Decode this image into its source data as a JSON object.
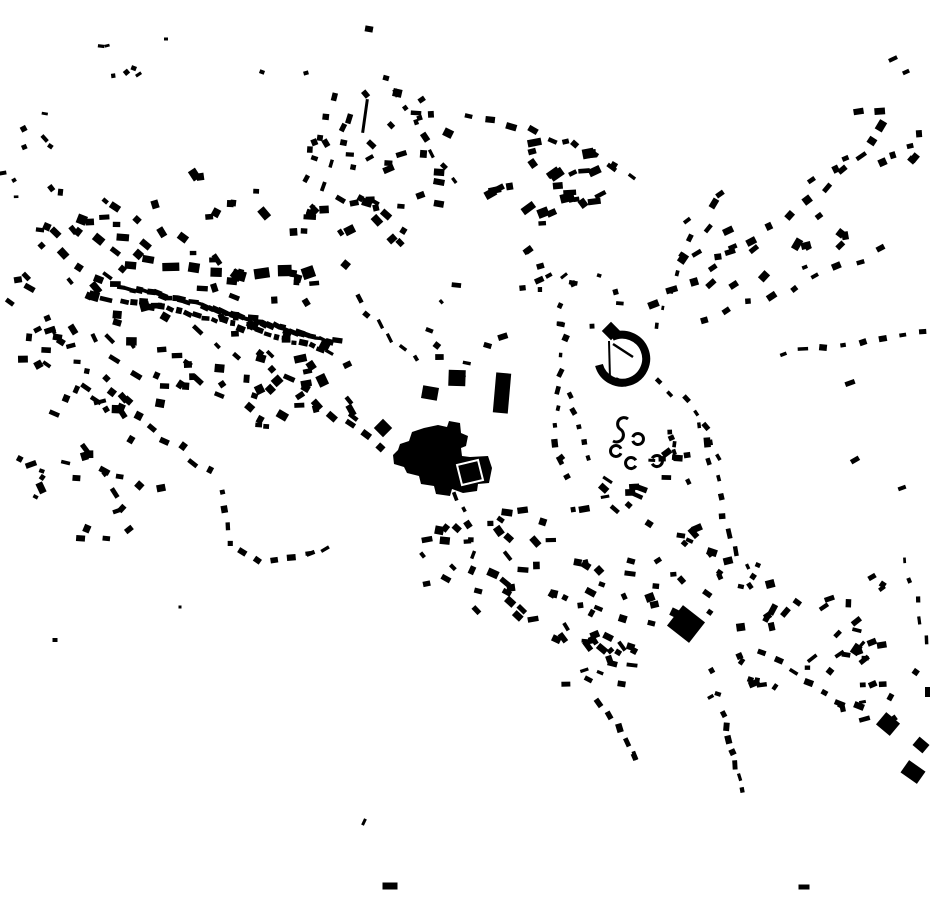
{
  "map": {
    "width": 930,
    "height": 924,
    "background_color": "#ffffff",
    "ink_color": "#000000",
    "seed": 7
  },
  "features": {
    "paths": [
      {
        "name": "central-complex-footprint",
        "d": "M393,455 L398,450 L400,444 L409,441 L412,432 L424,428 L438,425 L447,427 L449,421 L460,423 L461,433 L468,436 L466,446 L461,448 L462,456 L470,457 L488,456 L492,468 L489,483 L478,484 L477,491 L463,493 L452,489 L450,496 L436,494 L434,486 L421,484 L419,476 L407,473 L404,467 L394,464 Z",
        "fill": "#000000"
      },
      {
        "name": "crescent-building-arc",
        "d": "M612,337 A24,24 0 1 1 599,365",
        "stroke": "#000000",
        "sw": 8
      },
      {
        "name": "crescent-chord-wall",
        "d": "M609,341 L610,379",
        "stroke": "#000000",
        "sw": 2
      },
      {
        "name": "crescent-inner-wall",
        "d": "M613,344 L633,357",
        "stroke": "#000000",
        "sw": 2.5
      },
      {
        "name": "s-shaped-ruin",
        "d": "M628,419 A6,6 0 1 0 620,429 A6,6 0 1 1 613,441",
        "stroke": "#000000",
        "sw": 3
      }
    ],
    "overlays": [
      {
        "name": "courtyard-outline",
        "d": "M457,465 L478,460 L483,480 L462,485 Z",
        "stroke": "#ffffff",
        "sw": 2
      }
    ],
    "arcs": [
      {
        "cx": 638,
        "cy": 439,
        "r": 5.5,
        "a0": -160,
        "a1": 160,
        "sw": 3
      },
      {
        "cx": 616,
        "cy": 451,
        "r": 5.5,
        "a0": 25,
        "a1": 335,
        "sw": 3
      },
      {
        "cx": 631,
        "cy": 463,
        "r": 5.5,
        "a0": 30,
        "a1": 330,
        "sw": 3
      },
      {
        "cx": 657,
        "cy": 461,
        "r": 5.5,
        "a0": -150,
        "a1": 150,
        "sw": 3
      }
    ],
    "rects": [
      [
        611,
        331,
        13,
        13,
        45
      ],
      [
        621,
        382,
        12,
        5,
        25
      ],
      [
        457,
        378,
        17,
        16,
        2
      ],
      [
        430,
        393,
        16,
        13,
        10
      ],
      [
        383,
        428,
        13,
        13,
        45
      ],
      [
        502,
        393,
        15,
        40,
        5
      ],
      [
        365,
        116,
        3,
        34,
        8
      ],
      [
        369,
        29,
        8,
        6,
        10
      ],
      [
        262,
        72,
        5,
        4,
        20
      ],
      [
        306,
        73,
        5,
        4,
        -15
      ],
      [
        386,
        78,
        6,
        5,
        15
      ],
      [
        166,
        39,
        4,
        3,
        0
      ],
      [
        893,
        59,
        9,
        4,
        -25
      ],
      [
        906,
        72,
        7,
        4,
        -25
      ],
      [
        850,
        383,
        10,
        5,
        -20
      ],
      [
        855,
        460,
        9,
        5,
        -30
      ],
      [
        902,
        488,
        8,
        4,
        -20
      ],
      [
        872,
        577,
        8,
        5,
        -30
      ],
      [
        888,
        724,
        18,
        16,
        40
      ],
      [
        921,
        745,
        13,
        11,
        40
      ],
      [
        913,
        772,
        20,
        15,
        35
      ],
      [
        928,
        692,
        6,
        10,
        0
      ],
      [
        686,
        624,
        28,
        26,
        38
      ],
      [
        390,
        886,
        15,
        7,
        0
      ],
      [
        804,
        887,
        11,
        5,
        0
      ],
      [
        364,
        822,
        3,
        7,
        25
      ],
      [
        55,
        640,
        5,
        4,
        0
      ],
      [
        180,
        607,
        3,
        3,
        0
      ]
    ]
  },
  "streets": [
    {
      "pts": [
        [
          115,
          286
        ],
        [
          170,
          297
        ],
        [
          230,
          313
        ],
        [
          300,
          334
        ],
        [
          335,
          345
        ]
      ],
      "n": 38,
      "w": 8,
      "h": 5,
      "jit": 2,
      "rj": 12
    },
    {
      "pts": [
        [
          125,
          300
        ],
        [
          200,
          316
        ],
        [
          280,
          336
        ],
        [
          330,
          350
        ]
      ],
      "n": 24,
      "w": 7,
      "h": 5,
      "jit": 3,
      "rj": 15
    },
    {
      "pts": [
        [
          148,
          262
        ],
        [
          205,
          266
        ],
        [
          258,
          277
        ],
        [
          308,
          270
        ]
      ],
      "n": 8,
      "w": 16,
      "h": 10,
      "jit": 4,
      "rj": 12
    },
    {
      "pts": [
        [
          352,
          120
        ],
        [
          330,
          170
        ],
        [
          312,
          215
        ],
        [
          300,
          255
        ]
      ],
      "n": 7,
      "w": 8,
      "h": 5,
      "jit": 4,
      "rj": 15
    },
    {
      "pts": [
        [
          258,
          356
        ],
        [
          300,
          388
        ],
        [
          345,
          422
        ],
        [
          380,
          448
        ]
      ],
      "n": 9,
      "w": 9,
      "h": 6,
      "jit": 5,
      "rj": 15
    },
    {
      "pts": [
        [
          112,
          392
        ],
        [
          160,
          432
        ],
        [
          210,
          470
        ]
      ],
      "n": 8,
      "w": 8,
      "h": 6,
      "jit": 5,
      "rj": 15
    },
    {
      "pts": [
        [
          224,
          492
        ],
        [
          228,
          545
        ],
        [
          262,
          562
        ],
        [
          310,
          552
        ],
        [
          340,
          540
        ]
      ],
      "n": 11,
      "w": 7,
      "h": 5,
      "jit": 3,
      "rj": 15
    },
    {
      "pts": [
        [
          332,
          96
        ],
        [
          312,
          150
        ],
        [
          302,
          200
        ]
      ],
      "n": 6,
      "w": 7,
      "h": 5,
      "jit": 4,
      "rj": 18
    },
    {
      "pts": [
        [
          398,
          92
        ],
        [
          424,
          142
        ],
        [
          452,
          182
        ]
      ],
      "n": 7,
      "w": 7,
      "h": 5,
      "jit": 4,
      "rj": 18
    },
    {
      "pts": [
        [
          468,
          120
        ],
        [
          522,
          128
        ],
        [
          568,
          142
        ],
        [
          612,
          168
        ],
        [
          648,
          192
        ]
      ],
      "n": 10,
      "w": 8,
      "h": 5,
      "jit": 4,
      "rj": 18
    },
    {
      "pts": [
        [
          652,
          302
        ],
        [
          700,
          272
        ],
        [
          748,
          240
        ],
        [
          794,
          206
        ],
        [
          838,
          172
        ],
        [
          878,
          140
        ]
      ],
      "n": 13,
      "w": 9,
      "h": 6,
      "jit": 6,
      "rj": 18
    },
    {
      "pts": [
        [
          705,
          322
        ],
        [
          762,
          300
        ],
        [
          822,
          276
        ],
        [
          882,
          252
        ]
      ],
      "n": 9,
      "w": 8,
      "h": 5,
      "jit": 5,
      "rj": 18
    },
    {
      "pts": [
        [
          783,
          352
        ],
        [
          822,
          346
        ],
        [
          858,
          341
        ],
        [
          894,
          336
        ],
        [
          922,
          329
        ]
      ],
      "n": 8,
      "w": 8,
      "h": 5,
      "jit": 3,
      "rj": 15
    },
    {
      "pts": [
        [
          700,
          425
        ],
        [
          712,
          465
        ],
        [
          722,
          505
        ],
        [
          737,
          548
        ],
        [
          752,
          585
        ]
      ],
      "n": 10,
      "w": 8,
      "h": 5,
      "jit": 4,
      "rj": 15
    },
    {
      "pts": [
        [
          358,
          300
        ],
        [
          386,
          330
        ],
        [
          414,
          360
        ]
      ],
      "n": 6,
      "w": 8,
      "h": 5,
      "jit": 4,
      "rj": 18
    },
    {
      "pts": [
        [
          566,
          338
        ],
        [
          559,
          380
        ],
        [
          554,
          420
        ],
        [
          560,
          458
        ],
        [
          576,
          492
        ]
      ],
      "n": 10,
      "w": 7,
      "h": 5,
      "jit": 3,
      "rj": 18
    },
    {
      "pts": [
        [
          655,
          325
        ],
        [
          668,
          295
        ],
        [
          680,
          265
        ],
        [
          690,
          238
        ]
      ],
      "n": 6,
      "w": 6,
      "h": 4,
      "jit": 3,
      "rj": 18
    },
    {
      "pts": [
        [
          658,
          382
        ],
        [
          686,
          402
        ],
        [
          706,
          428
        ],
        [
          716,
          458
        ]
      ],
      "n": 7,
      "w": 6,
      "h": 4,
      "jit": 3,
      "rj": 18
    },
    {
      "pts": [
        [
          670,
          432
        ],
        [
          674,
          452
        ],
        [
          676,
          470
        ]
      ],
      "n": 4,
      "w": 6,
      "h": 4,
      "jit": 2,
      "rj": 20
    },
    {
      "pts": [
        [
          568,
          396
        ],
        [
          577,
          428
        ],
        [
          588,
          458
        ]
      ],
      "n": 5,
      "w": 6,
      "h": 4,
      "jit": 3,
      "rj": 18
    },
    {
      "pts": [
        [
          456,
          496
        ],
        [
          466,
          520
        ],
        [
          473,
          545
        ],
        [
          470,
          570
        ]
      ],
      "n": 6,
      "w": 7,
      "h": 5,
      "jit": 3,
      "rj": 18
    },
    {
      "pts": [
        [
          600,
          702
        ],
        [
          618,
          730
        ],
        [
          634,
          756
        ],
        [
          640,
          772
        ]
      ],
      "n": 6,
      "w": 7,
      "h": 5,
      "jit": 3,
      "rj": 18
    },
    {
      "pts": [
        [
          724,
          714
        ],
        [
          730,
          742
        ],
        [
          736,
          768
        ],
        [
          742,
          790
        ]
      ],
      "n": 7,
      "w": 7,
      "h": 5,
      "jit": 3,
      "rj": 18
    },
    {
      "pts": [
        [
          762,
          652
        ],
        [
          802,
          680
        ],
        [
          842,
          702
        ],
        [
          876,
          714
        ]
      ],
      "n": 8,
      "w": 8,
      "h": 5,
      "jit": 4,
      "rj": 18
    },
    {
      "pts": [
        [
          906,
          560
        ],
        [
          916,
          600
        ],
        [
          926,
          640
        ]
      ],
      "n": 5,
      "w": 7,
      "h": 4,
      "jit": 3,
      "rj": 18
    }
  ],
  "scatters": [
    {
      "cx": 210,
      "cy": 250,
      "rx": 140,
      "ry": 85,
      "n": 55,
      "w": 9,
      "h": 7,
      "rot": 20,
      "rj": 40
    },
    {
      "cx": 150,
      "cy": 352,
      "rx": 125,
      "ry": 65,
      "n": 45,
      "w": 9,
      "h": 6,
      "rot": 25,
      "rj": 40
    },
    {
      "cx": 62,
      "cy": 300,
      "rx": 58,
      "ry": 115,
      "n": 26,
      "w": 8,
      "h": 6,
      "rot": 20,
      "rj": 45
    },
    {
      "cx": 285,
      "cy": 382,
      "rx": 90,
      "ry": 55,
      "n": 28,
      "w": 9,
      "h": 7,
      "rot": 25,
      "rj": 40
    },
    {
      "cx": 85,
      "cy": 478,
      "rx": 85,
      "ry": 65,
      "n": 24,
      "w": 8,
      "h": 6,
      "rot": 20,
      "rj": 45
    },
    {
      "cx": 112,
      "cy": 68,
      "rx": 38,
      "ry": 28,
      "n": 6,
      "w": 5,
      "h": 4,
      "rot": 0,
      "rj": 45
    },
    {
      "cx": 40,
      "cy": 160,
      "rx": 42,
      "ry": 48,
      "n": 8,
      "w": 6,
      "h": 4,
      "rot": 10,
      "rj": 45
    },
    {
      "cx": 385,
      "cy": 168,
      "rx": 85,
      "ry": 78,
      "n": 38,
      "w": 8,
      "h": 6,
      "rot": 0,
      "rj": 60
    },
    {
      "cx": 546,
      "cy": 185,
      "rx": 58,
      "ry": 48,
      "n": 28,
      "w": 10,
      "h": 7,
      "rot": -20,
      "rj": 18
    },
    {
      "cx": 760,
      "cy": 232,
      "rx": 88,
      "ry": 66,
      "n": 22,
      "w": 9,
      "h": 6,
      "rot": -30,
      "rj": 30
    },
    {
      "cx": 882,
      "cy": 150,
      "rx": 45,
      "ry": 52,
      "n": 11,
      "w": 9,
      "h": 6,
      "rot": -30,
      "rj": 30
    },
    {
      "cx": 470,
      "cy": 330,
      "rx": 58,
      "ry": 55,
      "n": 9,
      "w": 7,
      "h": 5,
      "rot": 10,
      "rj": 40
    },
    {
      "cx": 580,
      "cy": 300,
      "rx": 55,
      "ry": 38,
      "n": 9,
      "w": 7,
      "h": 5,
      "rot": 0,
      "rj": 40
    },
    {
      "cx": 555,
      "cy": 272,
      "rx": 45,
      "ry": 30,
      "n": 8,
      "w": 7,
      "h": 5,
      "rot": -15,
      "rj": 35
    },
    {
      "cx": 685,
      "cy": 455,
      "rx": 40,
      "ry": 30,
      "n": 8,
      "w": 7,
      "h": 5,
      "rot": -20,
      "rj": 30
    },
    {
      "cx": 520,
      "cy": 565,
      "rx": 105,
      "ry": 58,
      "n": 38,
      "w": 8,
      "h": 6,
      "rot": 25,
      "rj": 40
    },
    {
      "cx": 620,
      "cy": 612,
      "rx": 78,
      "ry": 62,
      "n": 28,
      "w": 8,
      "h": 6,
      "rot": 20,
      "rj": 45
    },
    {
      "cx": 706,
      "cy": 568,
      "rx": 55,
      "ry": 48,
      "n": 16,
      "w": 8,
      "h": 6,
      "rot": 20,
      "rj": 45
    },
    {
      "cx": 608,
      "cy": 506,
      "rx": 52,
      "ry": 30,
      "n": 12,
      "w": 8,
      "h": 5,
      "rot": 20,
      "rj": 40
    },
    {
      "cx": 818,
      "cy": 616,
      "rx": 80,
      "ry": 56,
      "n": 24,
      "w": 8,
      "h": 6,
      "rot": -25,
      "rj": 40
    },
    {
      "cx": 868,
      "cy": 682,
      "rx": 55,
      "ry": 46,
      "n": 13,
      "w": 8,
      "h": 5,
      "rot": -25,
      "rj": 40
    },
    {
      "cx": 600,
      "cy": 665,
      "rx": 55,
      "ry": 30,
      "n": 12,
      "w": 8,
      "h": 5,
      "rot": 20,
      "rj": 40
    },
    {
      "cx": 738,
      "cy": 672,
      "rx": 45,
      "ry": 32,
      "n": 10,
      "w": 8,
      "h": 5,
      "rot": -20,
      "rj": 40
    }
  ]
}
